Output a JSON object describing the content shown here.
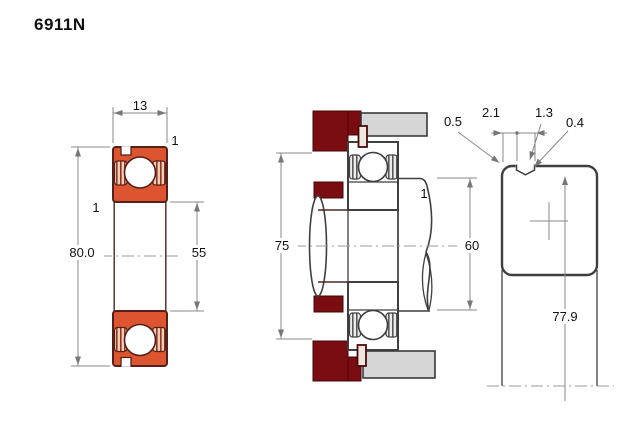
{
  "page": {
    "title": "6911N"
  },
  "colors": {
    "bearing_fill": "#dc5430",
    "bearing_outline": "#55201a",
    "housing_fill": "#7a0d12",
    "metal_fill": "#d6d6d6",
    "line": "#3f3f3f",
    "dim_line": "#888888",
    "text": "#111111"
  },
  "front_view": {
    "dims": {
      "width": "13",
      "outer_chamfer": "1",
      "inner_chamfer": "1",
      "outer_diameter": "80.0",
      "bore_diameter": "55"
    }
  },
  "mounted_view": {
    "dims": {
      "housing_shoulder_diameter": "75",
      "chamfer": "1",
      "shaft_shoulder_diameter": "60"
    }
  },
  "groove_detail_view": {
    "dims": {
      "edge_chamfer": "0.5",
      "groove_position": "2.1",
      "groove_width": "1.3",
      "groove_radius": "0.4",
      "groove_diameter": "77.9"
    }
  }
}
